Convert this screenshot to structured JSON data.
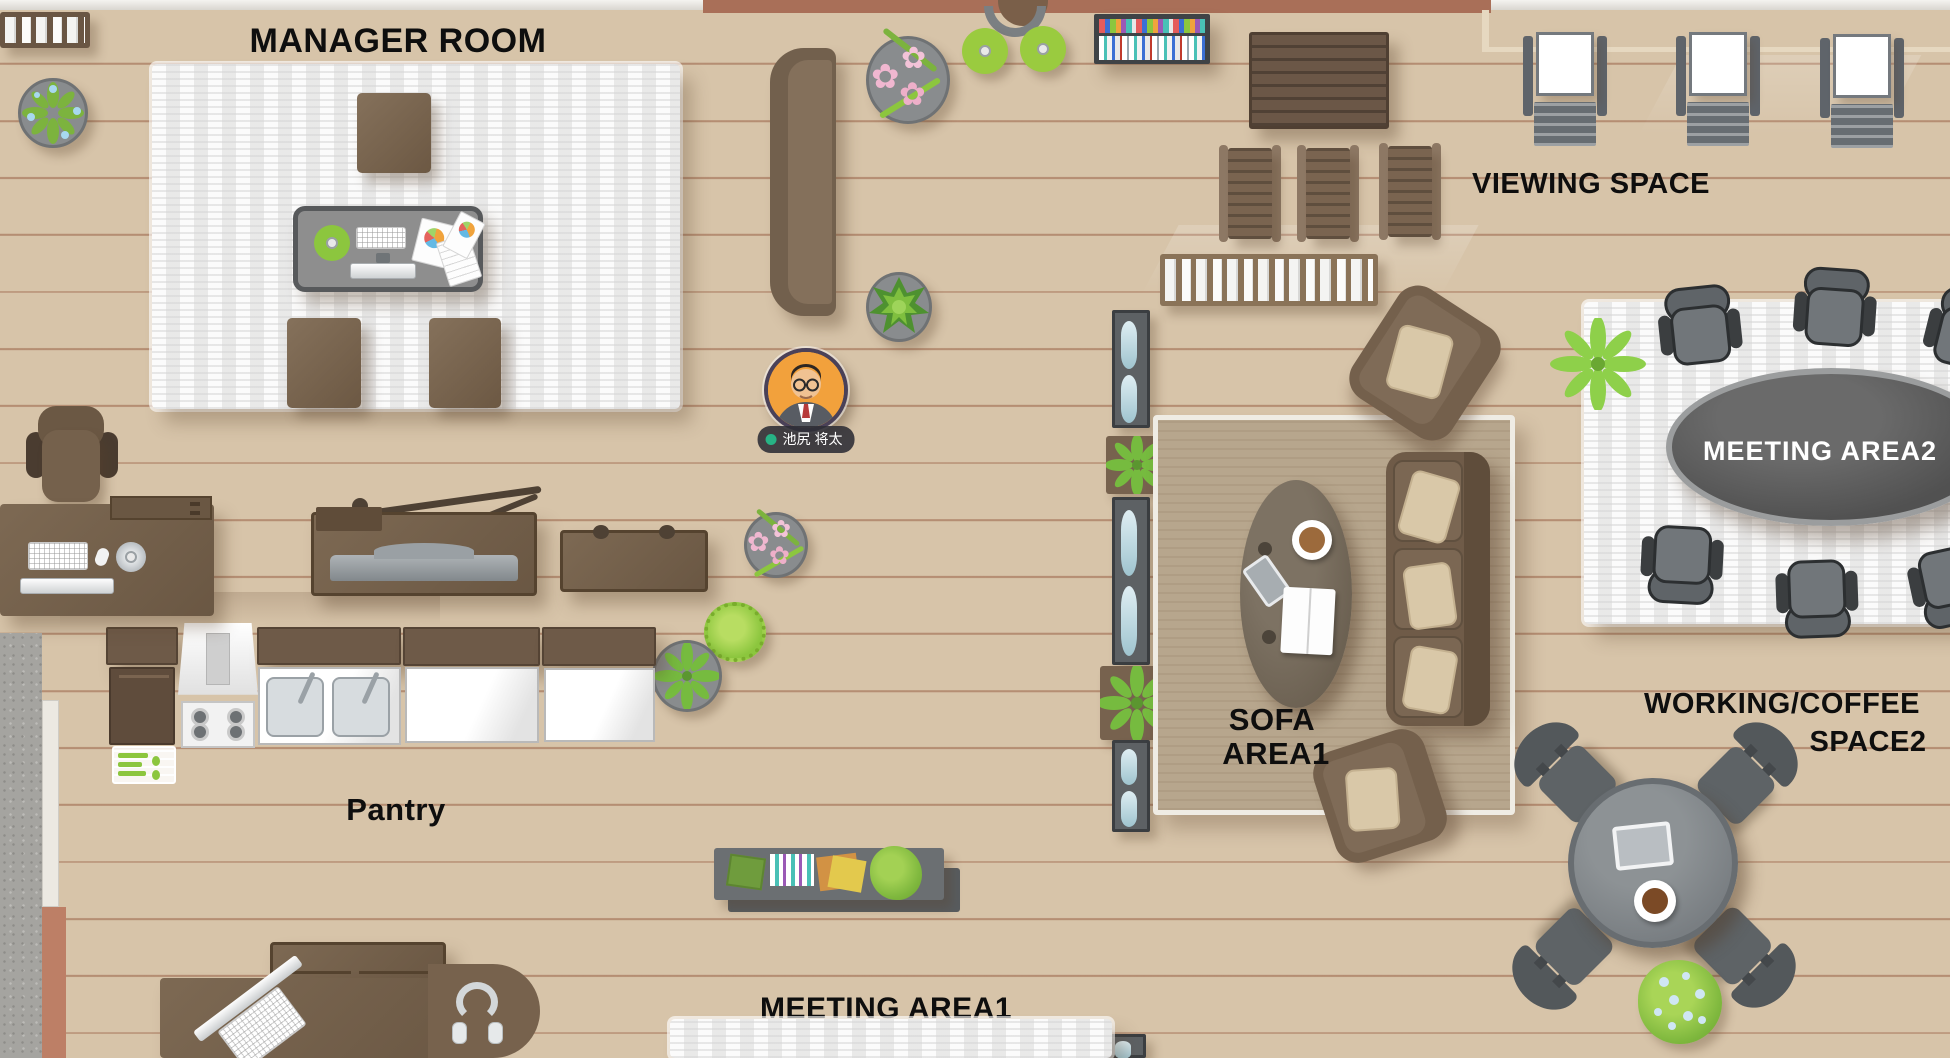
{
  "floor": {
    "wood_color": "#d7c4a9",
    "plank_line_color": "#99613f"
  },
  "areas": {
    "manager_room": {
      "label": "MANAGER ROOM"
    },
    "viewing_space": {
      "label": "VIEWING SPACE"
    },
    "meeting_area2": {
      "label": "MEETING AREA2"
    },
    "sofa_area1": {
      "line1": "SOFA",
      "line2": "AREA1"
    },
    "working_coffee_space2": {
      "line1": "WORKING/COFFEE",
      "line2": "SPACE2"
    },
    "pantry": {
      "label": "Pantry"
    },
    "meeting_area1": {
      "label": "MEETING AREA1"
    }
  },
  "avatar": {
    "name": "池尻 将太",
    "status_color": "#27b385"
  }
}
